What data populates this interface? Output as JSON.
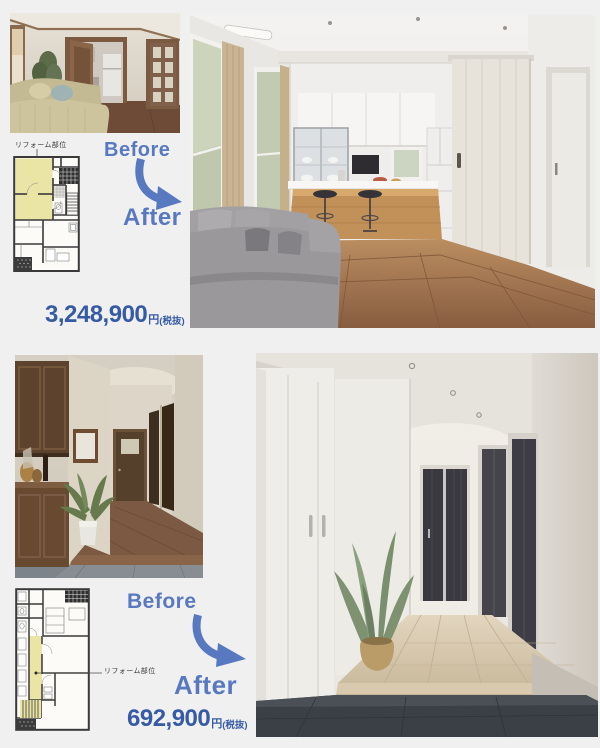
{
  "page": {
    "background": "#f1f0f1"
  },
  "colors": {
    "label_blue": "#5878c0",
    "price_blue": "#365aa4",
    "plan_highlight_yellow": "#eae5a4",
    "arrow_blue": "#5878c0"
  },
  "sections": [
    {
      "name": "living-dining-kitchen-renovation",
      "reform_area_label": "リフォーム部位",
      "before_label": "Before",
      "after_label": "After",
      "price_amount": "3,248,900",
      "price_currency": "円",
      "price_tax_note": "(税抜)"
    },
    {
      "name": "hallway-entrance-renovation",
      "reform_area_label": "リフォーム部位",
      "before_label": "Before",
      "after_label": "After",
      "price_amount": "692,900",
      "price_currency": "円",
      "price_tax_note": "(税抜)"
    }
  ]
}
